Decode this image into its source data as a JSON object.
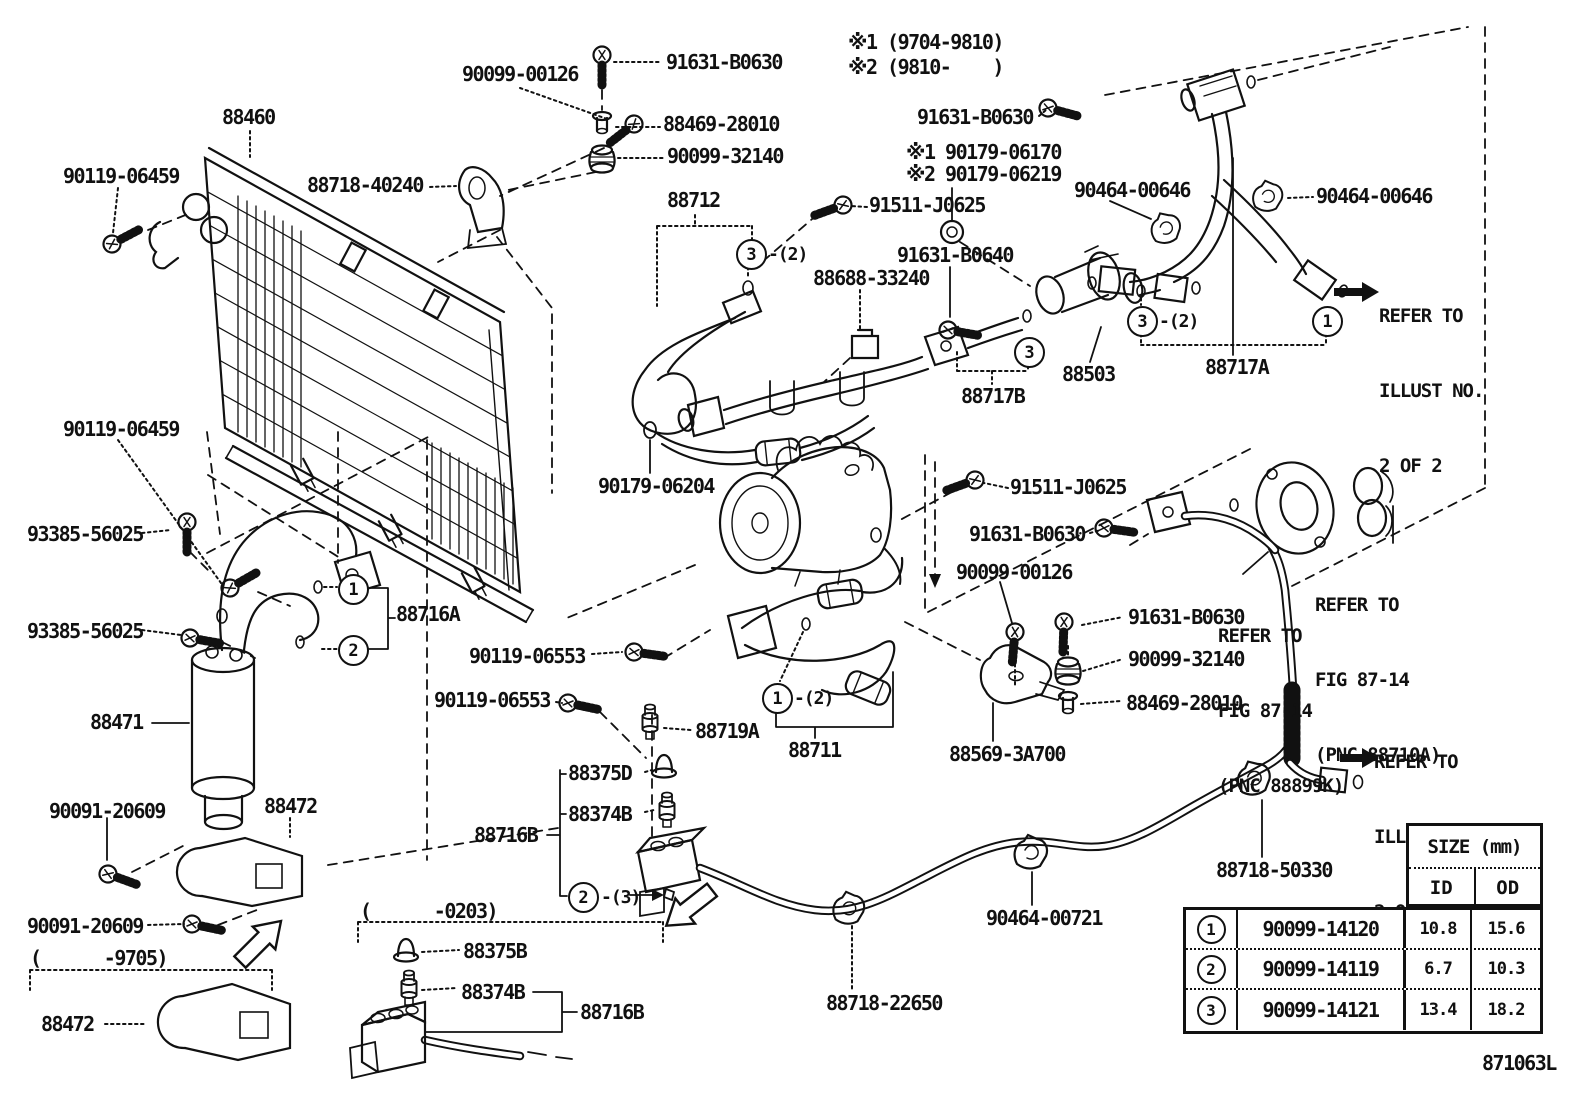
{
  "notes": {
    "n1": "※1 (9704-9810)",
    "n2": "※2 (9810-    )"
  },
  "parts": {
    "p90099_00126": "90099-00126",
    "p91631_B0630": "91631-B0630",
    "p88469_28010": "88469-28010",
    "p90099_32140": "90099-32140",
    "p88460": "88460",
    "p90119_06459": "90119-06459",
    "p88718_40240": "88718-40240",
    "p90179_06170": "※1 90179-06170",
    "p90179_06219": "※2 90179-06219",
    "p90464_00646": "90464-00646",
    "p88712": "88712",
    "p91511_J0625": "91511-J0625",
    "p91631_B0640": "91631-B0640",
    "p88688_33240": "88688-33240",
    "p88503": "88503",
    "p88717B": "88717B",
    "p88717A": "88717A",
    "p93385_56025": "93385-56025",
    "p90179_06204": "90179-06204",
    "p88716A": "88716A",
    "p90119_06553": "90119-06553",
    "p88719A": "88719A",
    "p88375D": "88375D",
    "p88374B": "88374B",
    "p88716B": "88716B",
    "p88711": "88711",
    "p88569_3A700": "88569-3A700",
    "p88471": "88471",
    "p90091_20609": "90091-20609",
    "p88472": "88472",
    "p88375B": "88375B",
    "p88718_22650": "88718-22650",
    "p90464_00721": "90464-00721",
    "p88718_50330": "88718-50330"
  },
  "ranges": {
    "r9705": "(      -9705)",
    "r0203": "(      -0203)"
  },
  "refer_illust": {
    "line1": "REFER TO",
    "line2": "ILLUST NO.",
    "line3": "2 OF 2"
  },
  "refer_fig_88899k": {
    "line1": "REFER TO",
    "line2": "FIG 87-14",
    "line3": "(PNC 88899K)"
  },
  "refer_fig_88710a": {
    "line1": "REFER TO",
    "line2": "FIG 87-14",
    "line3": "(PNC 88710A)"
  },
  "callouts": {
    "c1": "1",
    "c2": "2",
    "c3": "3",
    "qty2": "-(2)",
    "qty3": "-(3)"
  },
  "size_table": {
    "title": "SIZE (mm)",
    "col_id": "ID",
    "col_od": "OD",
    "rows": [
      {
        "num": "1",
        "part": "90099-14120",
        "id": "10.8",
        "od": "15.6"
      },
      {
        "num": "2",
        "part": "90099-14119",
        "id": "6.7",
        "od": "10.3"
      },
      {
        "num": "3",
        "part": "90099-14121",
        "id": "13.4",
        "od": "18.2"
      }
    ]
  },
  "drawing_number": "871063L"
}
